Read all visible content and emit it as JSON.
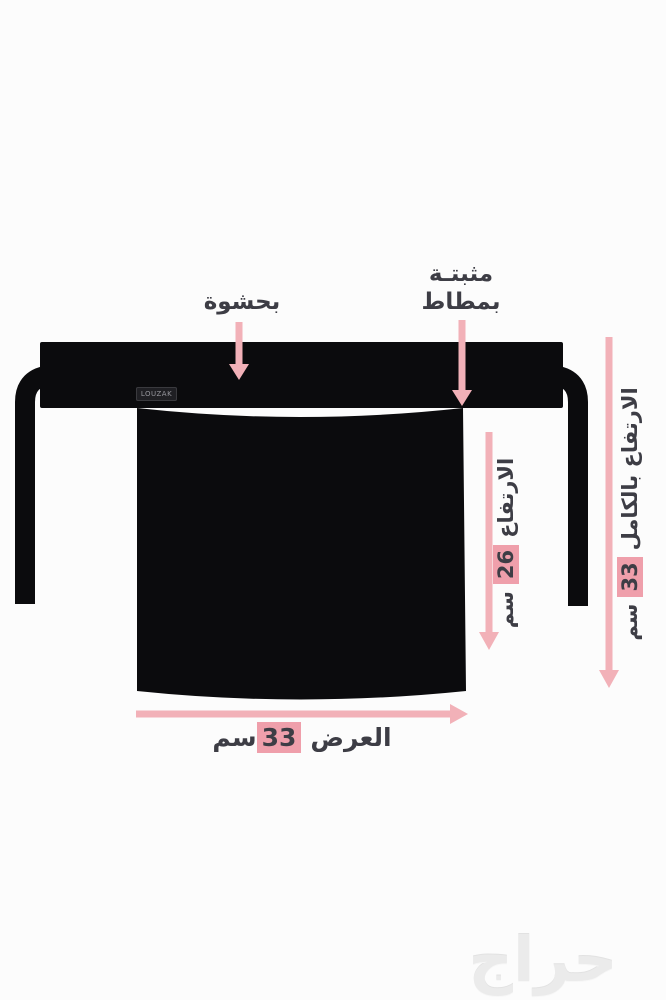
{
  "colors": {
    "background": "#fcfcfc",
    "product_black": "#0b0b0d",
    "arrow_pink": "#f2b1b8",
    "highlight_pink": "#ef9fab",
    "text_dark": "#3d3d45",
    "watermark_gray": "#ebebeb",
    "brand_label_bg": "#1f1f23",
    "brand_label_text": "#96969c"
  },
  "product": {
    "brand_label": "LOUZAK"
  },
  "annotations": {
    "padding_label": "بحشوة",
    "elastic_label_line1": "مثبتـة",
    "elastic_label_line2": "بمطاط",
    "height": {
      "prefix": "الارتفاع",
      "value": "26",
      "unit": "سم"
    },
    "full_height": {
      "prefix": "الارتفاع بالكامل",
      "value": "33",
      "unit": "سم"
    },
    "width": {
      "prefix": "العرض",
      "value": "33",
      "unit": "سم"
    }
  },
  "watermark": "حراج"
}
